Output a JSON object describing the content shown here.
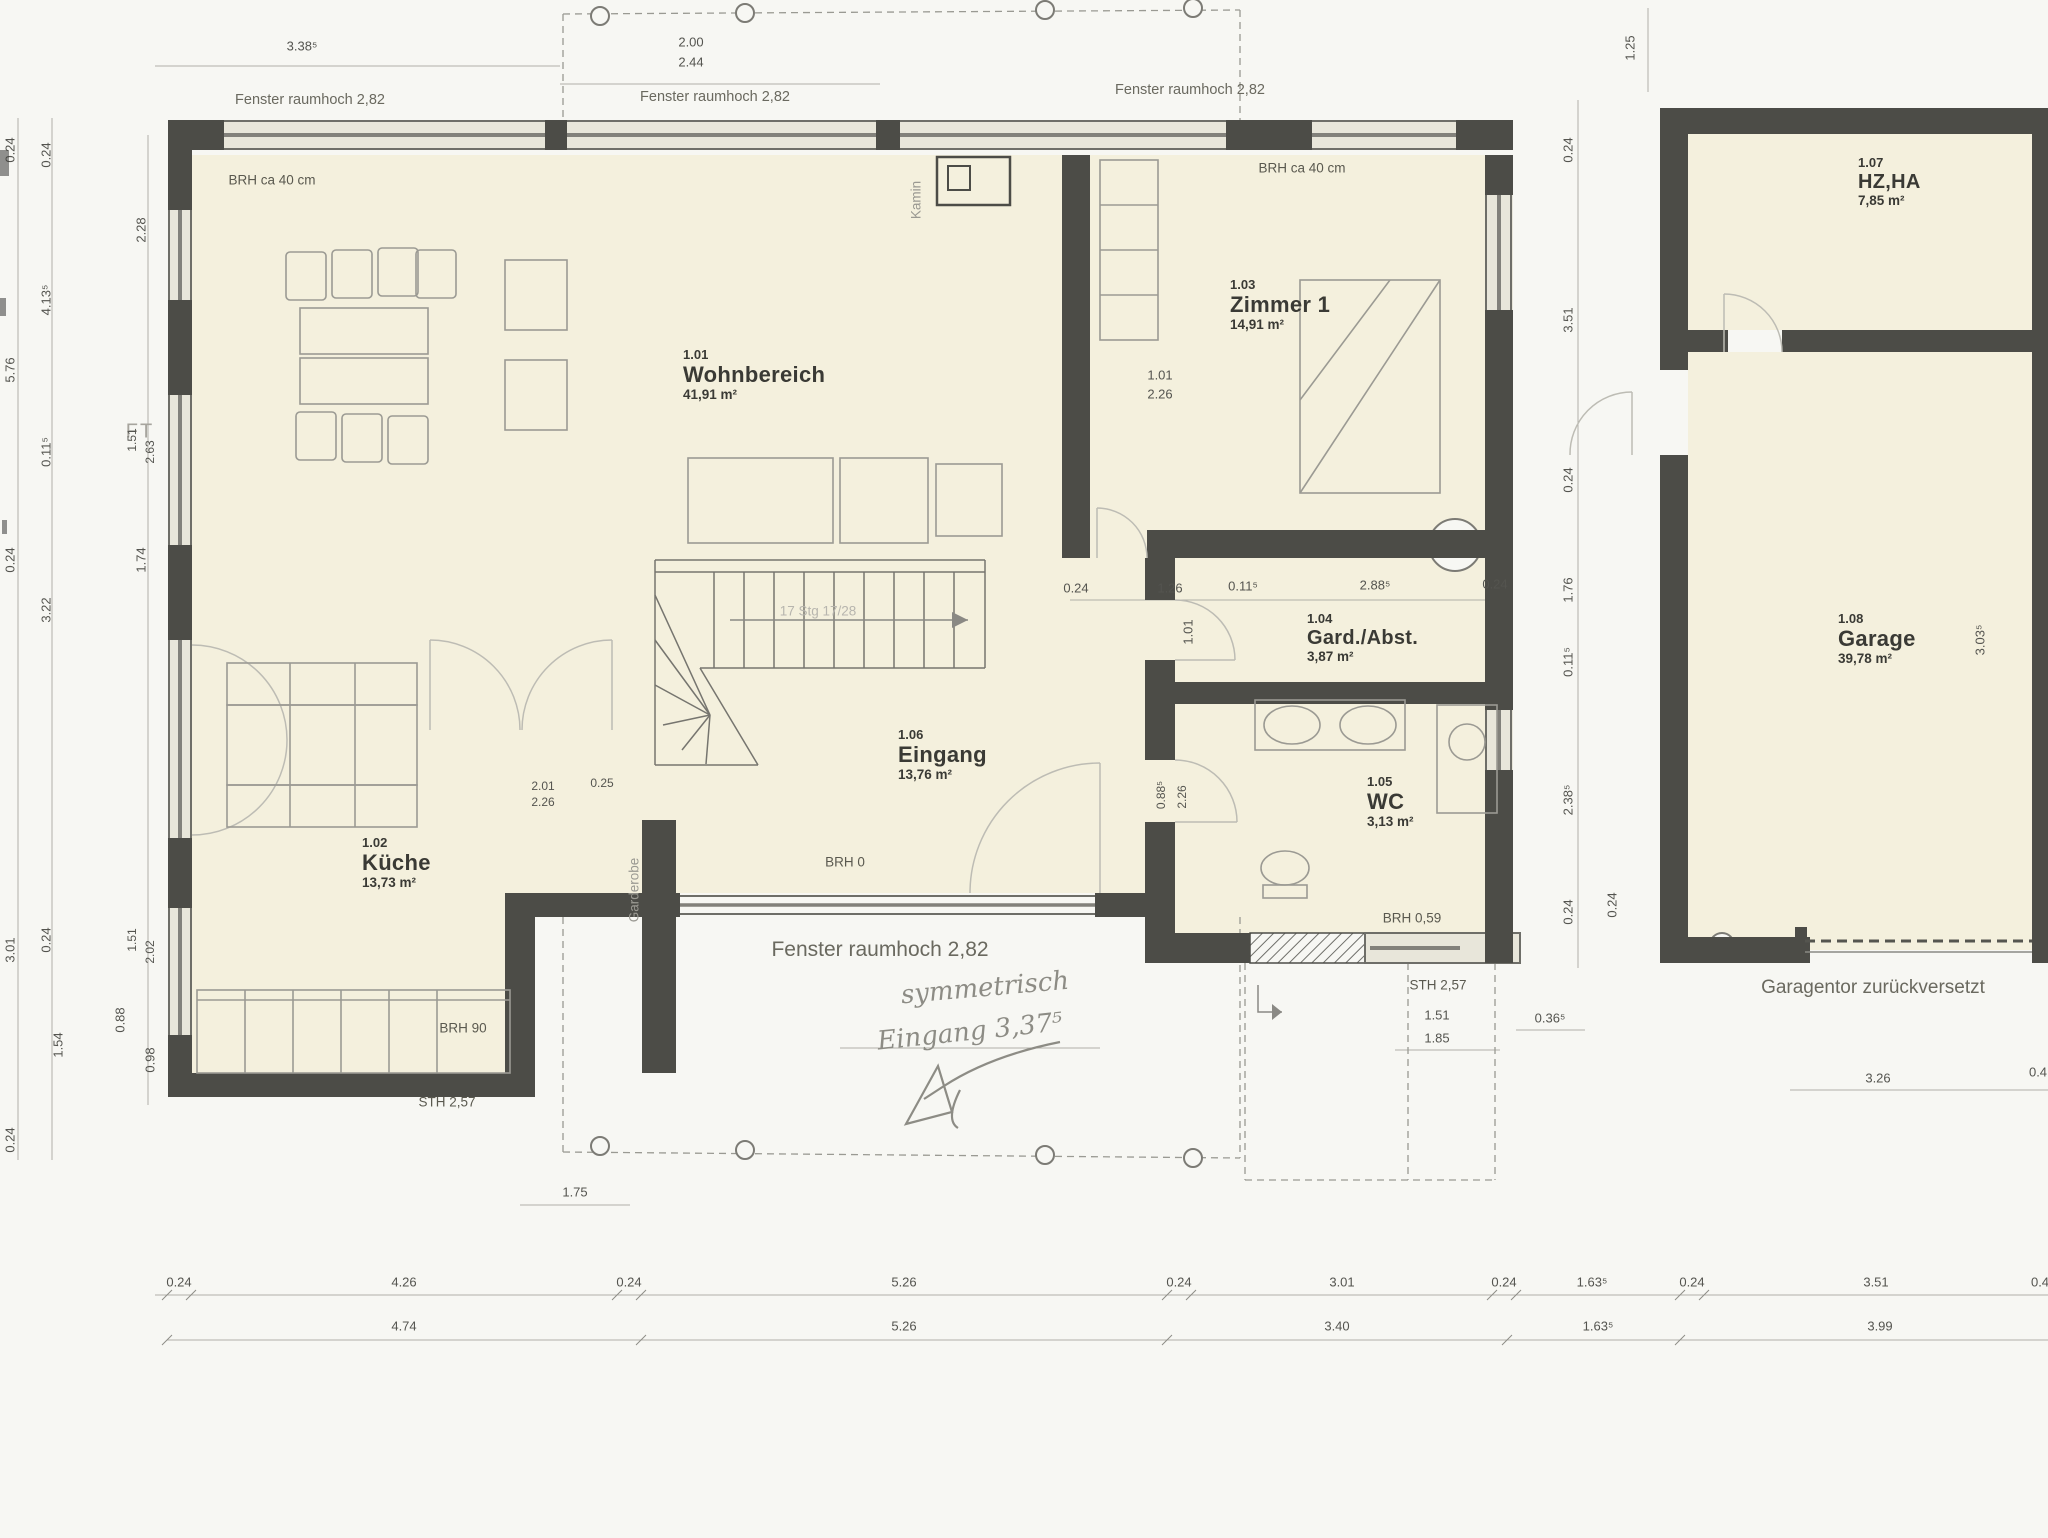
{
  "rooms": [
    {
      "number": "1.01",
      "name": "Wohnbereich",
      "area": "41,91 m²"
    },
    {
      "number": "1.02",
      "name": "Küche",
      "area": "13,73 m²"
    },
    {
      "number": "1.03",
      "name": "Zimmer 1",
      "area": "14,91 m²"
    },
    {
      "number": "1.04",
      "name": "Gard./Abst.",
      "area": "3,87 m²"
    },
    {
      "number": "1.05",
      "name": "WC",
      "area": "3,13 m²"
    },
    {
      "number": "1.06",
      "name": "Eingang",
      "area": "13,76 m²"
    },
    {
      "number": "1.07",
      "name": "HZ,HA",
      "area": "7,85 m²"
    },
    {
      "number": "1.08",
      "name": "Garage",
      "area": "39,78 m²"
    }
  ],
  "texts": {
    "fenster": "Fenster raumhoch 2,82",
    "brh40": "BRH ca 40 cm",
    "brh0": "BRH 0",
    "brh90": "BRH 90",
    "brh059": "BRH 0,59",
    "sth257": "STH 2,57",
    "stairs": "17 Stg 17/28",
    "kamin": "Kamin",
    "garderobe": "Garderobe",
    "ft": "FT",
    "garagentor": "Garagentor zurückversetzt",
    "hand1": "symmetrisch",
    "hand2": "Eingang 3,37⁵"
  },
  "dims": {
    "top": [
      "3.38⁵",
      "2.00",
      "2.44",
      "1.25"
    ],
    "left_outer": [
      "0.24",
      "5.76",
      "0.24",
      "3.01",
      "0.24"
    ],
    "left_mid": [
      "0.24",
      "4.13⁵",
      "0.11⁵",
      "3.22",
      "0.24",
      "1.54"
    ],
    "left_inner": [
      "2.28",
      "1.51",
      "2.63",
      "1.74",
      "1.51",
      "2.02",
      "0.98"
    ],
    "right_chain": [
      "0.24",
      "3.51",
      "0.24",
      "1.76",
      "0.11⁵",
      "2.38⁵",
      "0.24"
    ],
    "garage_side": [
      "3.03⁵"
    ],
    "corridor_row": [
      "0.24",
      "1.26",
      "0.11⁵",
      "2.88⁵",
      "0.24"
    ],
    "zimmer_door": [
      "1.01",
      "2.26"
    ],
    "gard_door": [
      "1.01"
    ],
    "wc_door": [
      "0.88⁵",
      "2.26"
    ],
    "kitchen_door": [
      "2.01",
      "2.26",
      "0.25"
    ],
    "kitchen_window": [
      "0.88"
    ],
    "bottom_row1": [
      "0.24",
      "4.26",
      "0.24",
      "5.26",
      "0.24",
      "3.01",
      "0.24",
      "1.63⁵",
      "0.24",
      "3.51",
      "0.4"
    ],
    "bottom_row2": [
      "4.74",
      "5.26",
      "3.40",
      "1.63⁵",
      "3.99"
    ],
    "terrace": [
      "1.75"
    ],
    "right_lower": [
      "STH 2,57",
      "1.51",
      "1.85",
      "0.36⁵",
      "0.24"
    ],
    "garage_bottom": [
      "3.26",
      "0.4"
    ]
  }
}
